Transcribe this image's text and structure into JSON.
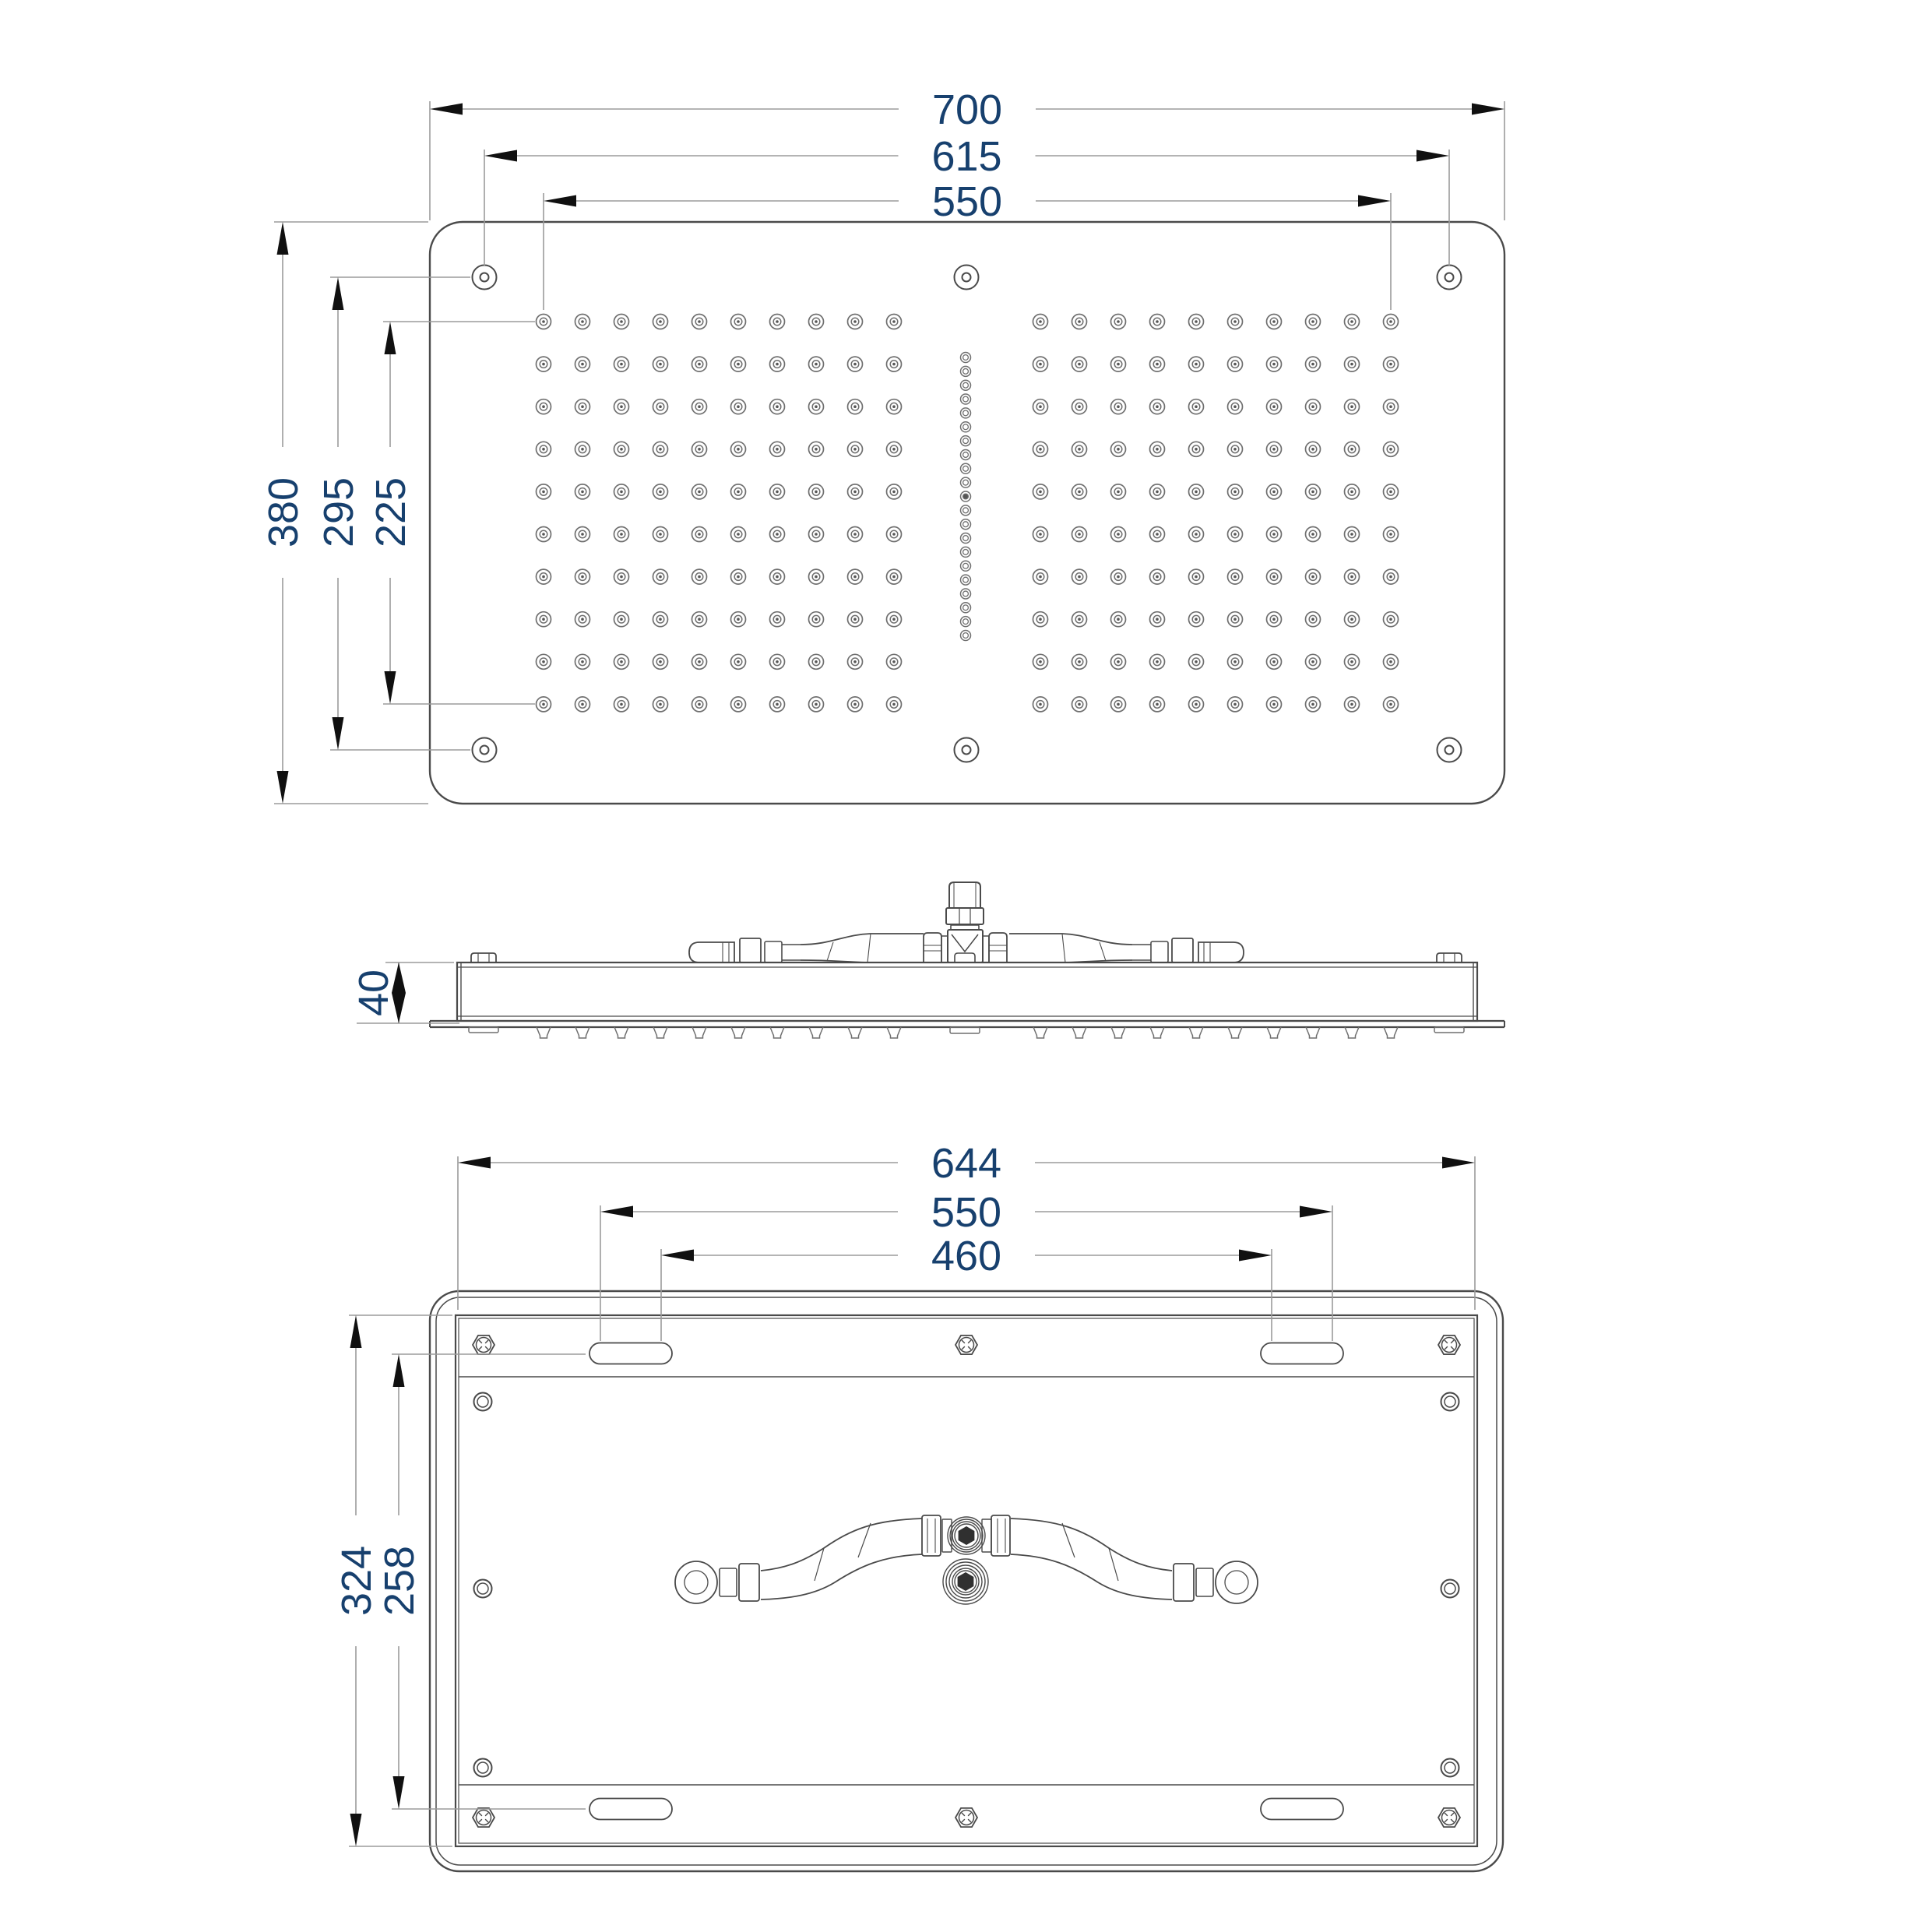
{
  "drawing": {
    "kind": "technical-drawing",
    "colors": {
      "background": "#ffffff",
      "line": "#4a4a4a",
      "line_soft": "#6f6f6f",
      "dim_line": "#9b9b9b",
      "arrow": "#101010",
      "dim_text": "#17406e",
      "dark_fill": "#303030",
      "dot_fill": "#555555"
    },
    "views": {
      "top": {
        "title": "top-view",
        "dims_horizontal": [
          {
            "label": "700"
          },
          {
            "label": "615"
          },
          {
            "label": "550"
          }
        ],
        "dims_vertical": [
          {
            "label": "380"
          },
          {
            "label": "295"
          },
          {
            "label": "225"
          }
        ],
        "nozzle_rows": 10,
        "nozzle_cols_per_side": 10,
        "center_nozzle_count": 21,
        "mounting_hole_count": 6
      },
      "side": {
        "title": "side-view",
        "dims_vertical": [
          {
            "label": "40"
          }
        ],
        "nozzle_tick_count": 20
      },
      "bottom": {
        "title": "bottom-view",
        "dims_horizontal": [
          {
            "label": "644"
          },
          {
            "label": "550"
          },
          {
            "label": "460"
          }
        ],
        "dims_vertical": [
          {
            "label": "324"
          },
          {
            "label": "258"
          }
        ],
        "hex_screw_count": 6,
        "slot_count": 4,
        "round_hole_count": 6
      }
    }
  }
}
